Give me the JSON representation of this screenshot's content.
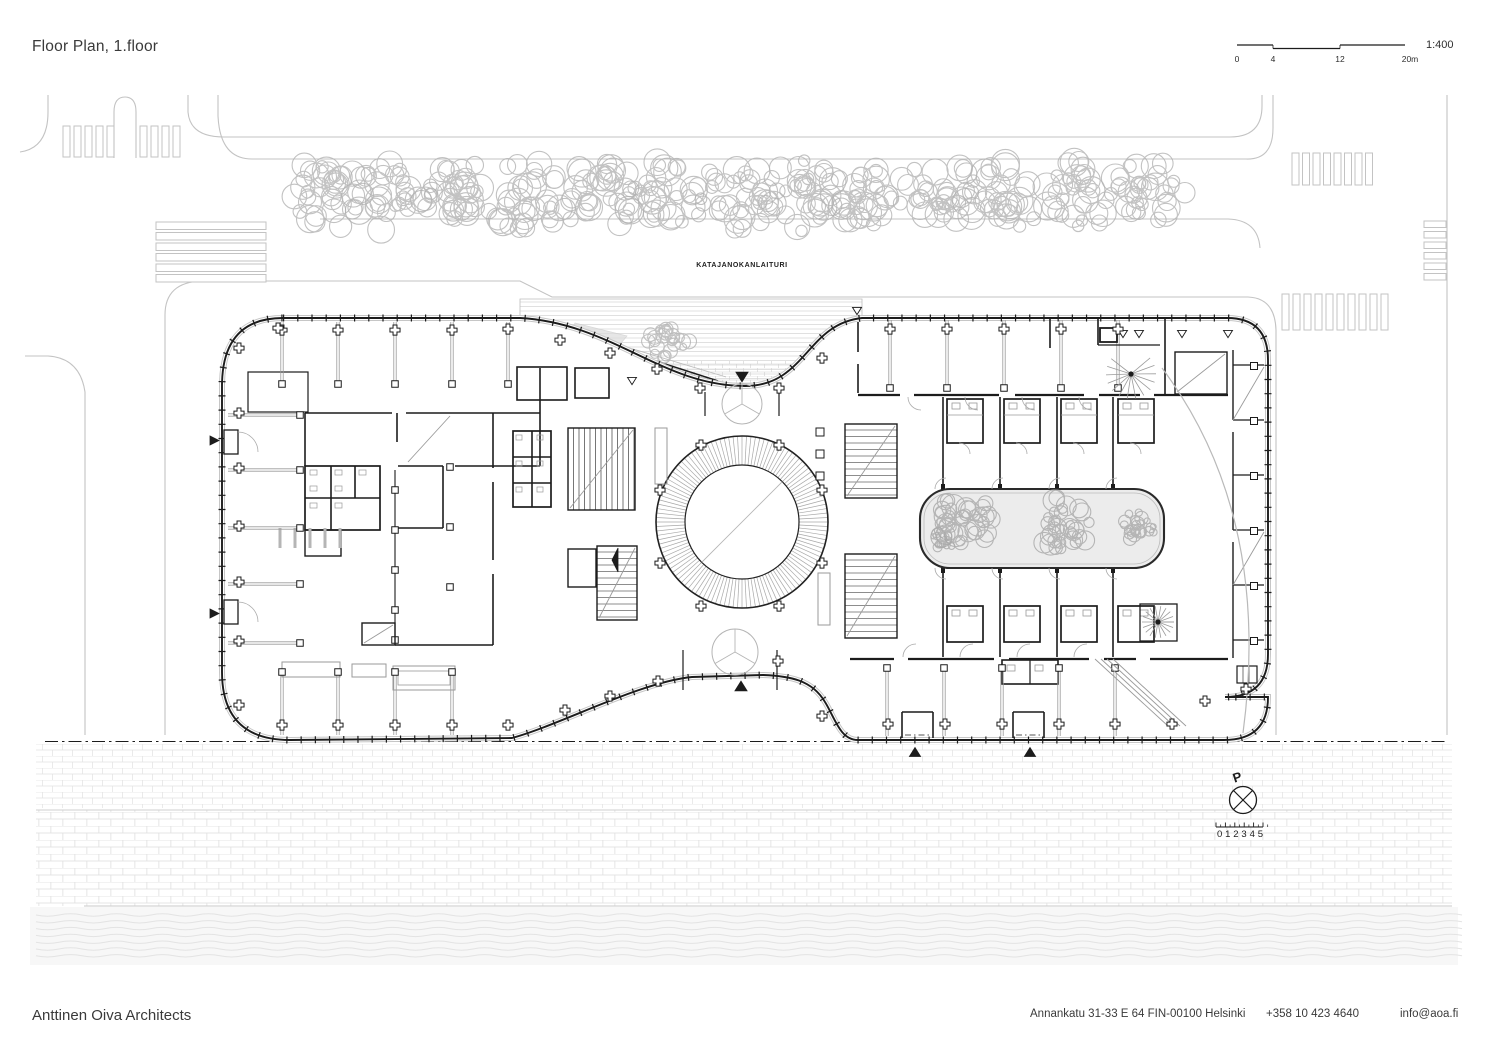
{
  "header": {
    "title": "Floor Plan, 1.floor"
  },
  "scale_bar": {
    "ratio": "1:400",
    "ticks": [
      "0",
      "4",
      "12",
      "20m"
    ]
  },
  "site": {
    "street_label": "KATAJANOKANLAITURI"
  },
  "compass": {
    "north_label": "P",
    "ruler_numbers": "0 1 2 3 4 5"
  },
  "footer": {
    "firm": "Anttinen Oiva Architects",
    "address": "Annankatu 31-33 E 64 FIN-00100 Helsinki",
    "phone": "+358 10 423 4640",
    "email": "info@aoa.fi"
  },
  "colors": {
    "ink": "#1c1c1c",
    "site_line": "#c3c3c3",
    "tree": "#b1b1b1",
    "courtyard_tree": "#a6a6a6",
    "courtyard_fill": "#ececec",
    "brick_line": "#e2e2e2",
    "water_line": "#e3e3e3",
    "water_fill": "#f7f7f7",
    "grey_detail": "#9a9a9a",
    "text": "#3a3a3a"
  }
}
